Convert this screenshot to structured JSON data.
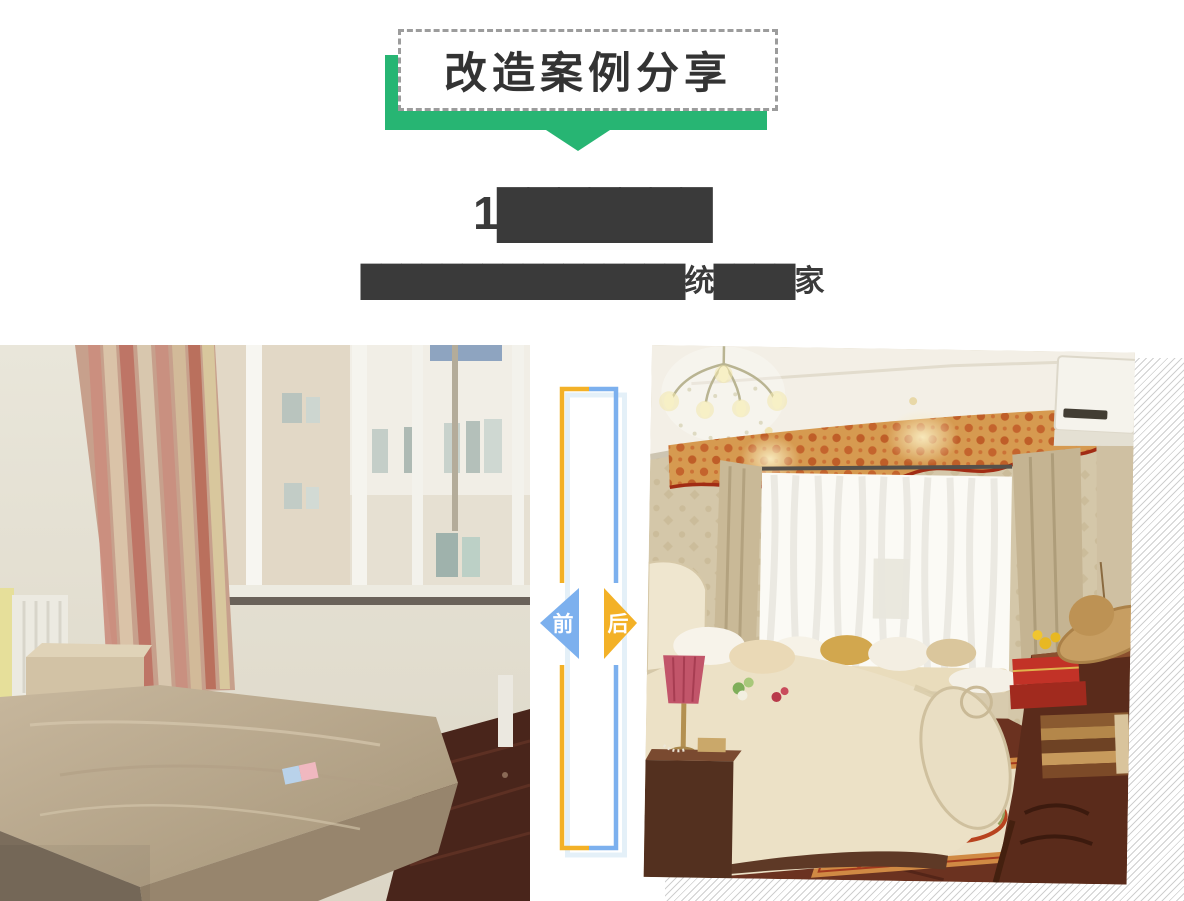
{
  "banner": {
    "title": "改造案例分享"
  },
  "case": {
    "title": "1███████",
    "subtitle": "████████████████统████家"
  },
  "comparison": {
    "before_label": "前",
    "after_label": "后"
  },
  "colors": {
    "banner_green": "#27b573",
    "dashed_border_gray": "#9c9c9c",
    "title_text": "#3a3a3a",
    "before_arrow_blue": "#7cb0ee",
    "after_arrow_yellow": "#f3b127",
    "frame_shadow_blue": "#e4f0f8",
    "hatch_gray": "#cfcfcf"
  }
}
